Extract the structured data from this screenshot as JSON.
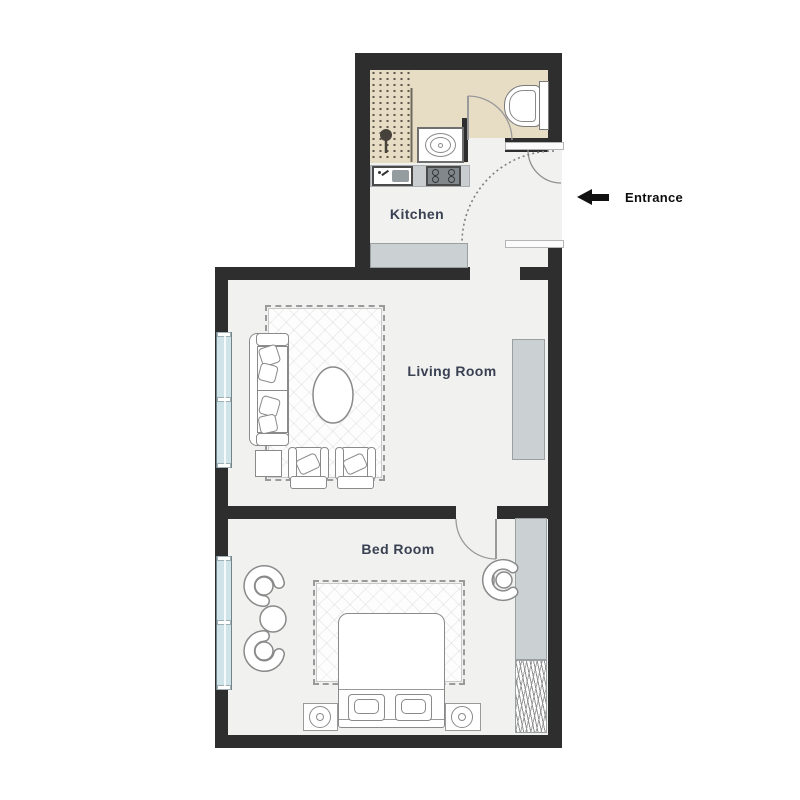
{
  "labels": {
    "kitchen": "Kitchen",
    "living_room": "Living Room",
    "bed_room": "Bed Room",
    "entrance": "Entrance"
  },
  "icons": {
    "entrance_arrow": "left-arrow"
  },
  "colors": {
    "wall": "#2e2e2e",
    "floor": "#f1f1f0",
    "bathroom_floor": "#e7ddc5",
    "window_glass": "#cfe4e9",
    "furniture_gray": "#cbd0d2",
    "outline_gray": "#8a8a8a",
    "room_label_text": "#3a4152",
    "entrance_text": "#0d0d0d"
  }
}
